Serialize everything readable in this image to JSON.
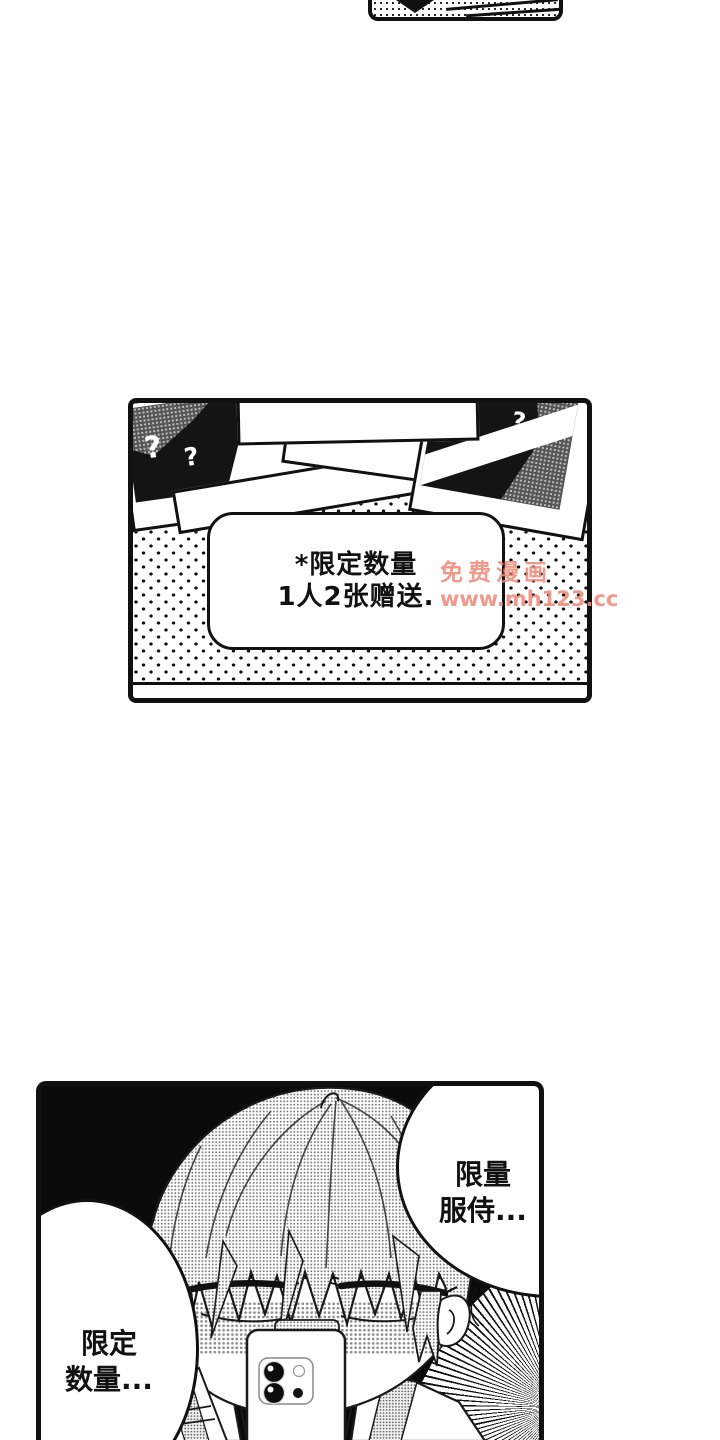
{
  "colors": {
    "ink": "#111111",
    "paper": "#ffffff",
    "watermark": "#ee8b7c"
  },
  "mid_panel": {
    "note_line1": "*限定数量",
    "note_line2": "1人2张赠送.",
    "left_photo": {
      "mark1": "?",
      "mark2": "?",
      "mark3": "?"
    },
    "right_photo": {
      "mark1": "?",
      "mark2": "?"
    }
  },
  "watermark": {
    "line1": "免费漫画",
    "line2": "www.mh123.cc"
  },
  "bottom_panel": {
    "bubble_right_line1": "限量",
    "bubble_right_line2": "服侍...",
    "bubble_left_line1": "限定",
    "bubble_left_line2": "数量..."
  }
}
